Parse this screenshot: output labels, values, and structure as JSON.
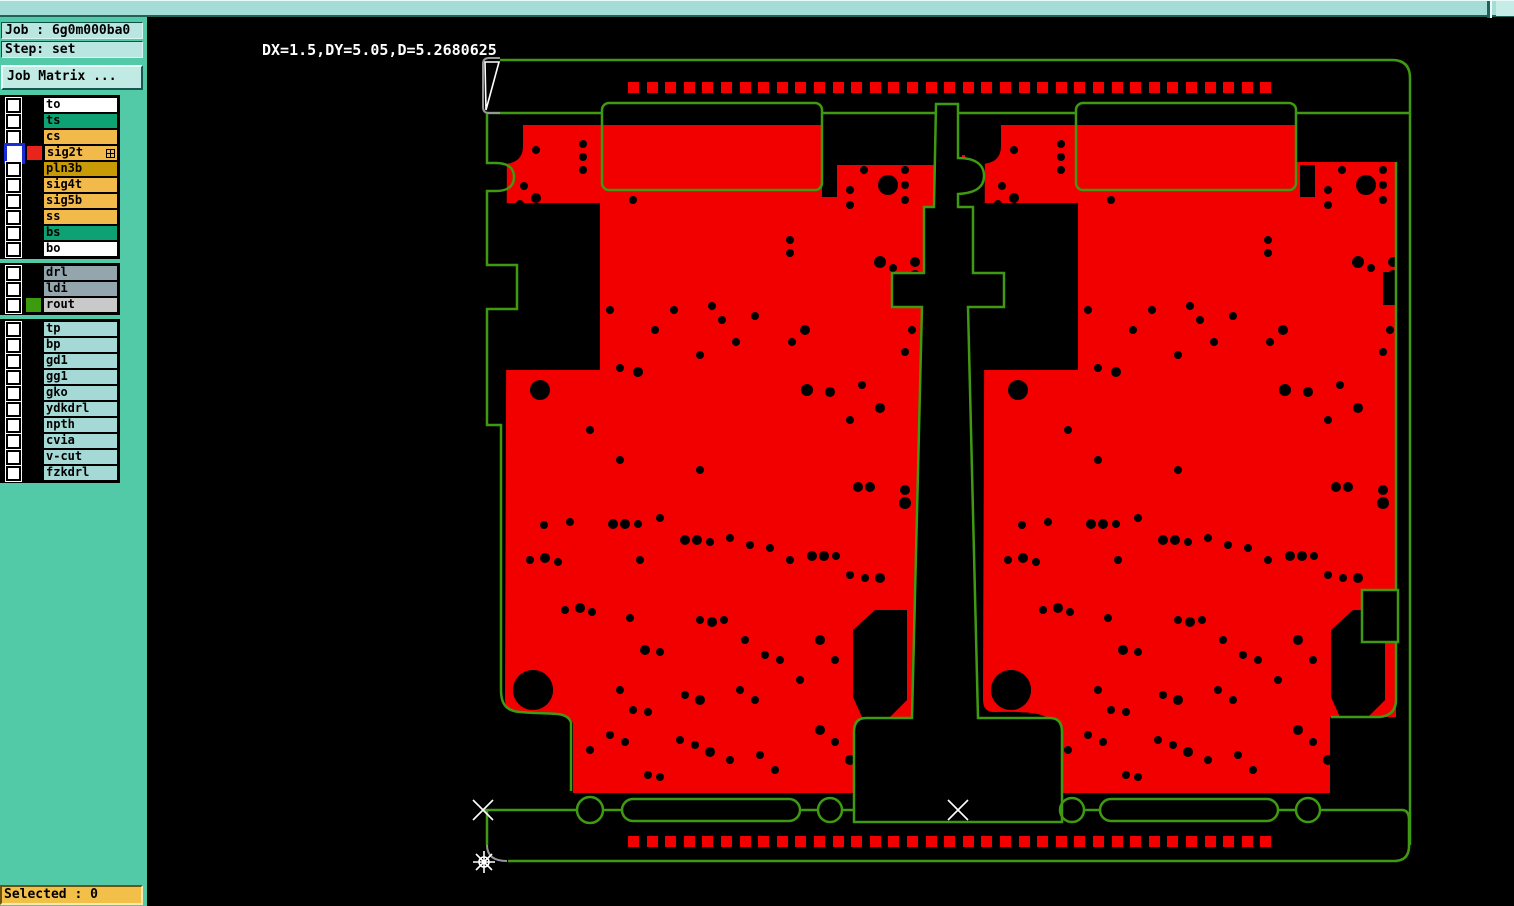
{
  "titlebar": {
    "note": ""
  },
  "sidebar": {
    "job_label": "Job : 6g0m000ba0",
    "step_label": "Step: set",
    "matrix_button": "Job Matrix ...",
    "selected_label": "Selected : 0",
    "layer_groups": [
      {
        "rows": [
          {
            "name": "to",
            "bg": "#ffffff",
            "chip": null,
            "selected": false,
            "expand": false
          },
          {
            "name": "ts",
            "bg": "#0da173",
            "chip": null,
            "selected": false,
            "expand": false
          },
          {
            "name": "cs",
            "bg": "#f2b94b",
            "chip": null,
            "selected": false,
            "expand": false
          },
          {
            "name": "sig2t",
            "bg": "#f2b94b",
            "chip": "#e8241c",
            "selected": true,
            "expand": true
          },
          {
            "name": "pln3b",
            "bg": "#c79a06",
            "chip": null,
            "selected": false,
            "expand": false
          },
          {
            "name": "sig4t",
            "bg": "#f2b94b",
            "chip": null,
            "selected": false,
            "expand": false
          },
          {
            "name": "sig5b",
            "bg": "#f2b94b",
            "chip": null,
            "selected": false,
            "expand": false
          },
          {
            "name": "ss",
            "bg": "#f2b94b",
            "chip": null,
            "selected": false,
            "expand": false
          },
          {
            "name": "bs",
            "bg": "#0da173",
            "chip": null,
            "selected": false,
            "expand": false
          },
          {
            "name": "bo",
            "bg": "#ffffff",
            "chip": null,
            "selected": false,
            "expand": false
          }
        ]
      },
      {
        "rows": [
          {
            "name": "drl",
            "bg": "#93a5ad",
            "chip": null,
            "selected": false,
            "expand": false
          },
          {
            "name": "ldi",
            "bg": "#93a5ad",
            "chip": null,
            "selected": false,
            "expand": false
          },
          {
            "name": "rout",
            "bg": "#c9c9c9",
            "chip": "#3c9b0e",
            "selected": false,
            "expand": false
          }
        ]
      },
      {
        "rows": [
          {
            "name": "tp",
            "bg": "#a5d9d5",
            "chip": null,
            "selected": false,
            "expand": false
          },
          {
            "name": "bp",
            "bg": "#a5d9d5",
            "chip": null,
            "selected": false,
            "expand": false
          },
          {
            "name": "gd1",
            "bg": "#a5d9d5",
            "chip": null,
            "selected": false,
            "expand": false
          },
          {
            "name": "gg1",
            "bg": "#a5d9d5",
            "chip": null,
            "selected": false,
            "expand": false
          },
          {
            "name": "gko",
            "bg": "#a5d9d5",
            "chip": null,
            "selected": false,
            "expand": false
          },
          {
            "name": "ydkdrl",
            "bg": "#a5d9d5",
            "chip": null,
            "selected": false,
            "expand": false
          },
          {
            "name": "npth",
            "bg": "#a5d9d5",
            "chip": null,
            "selected": false,
            "expand": false
          },
          {
            "name": "cvia",
            "bg": "#a5d9d5",
            "chip": null,
            "selected": false,
            "expand": false
          },
          {
            "name": "v-cut",
            "bg": "#a5d9d5",
            "chip": null,
            "selected": false,
            "expand": false
          },
          {
            "name": "fzkdrl",
            "bg": "#a5d9d5",
            "chip": null,
            "selected": false,
            "expand": false
          }
        ]
      }
    ]
  },
  "main": {
    "readout": "DX=1.5,DY=5.05,D=5.2680625",
    "colors": {
      "copper": "#f20000",
      "outline": "#3f9a12",
      "marker": "#ffffff",
      "corner": "#979797",
      "background": "#000000"
    },
    "fiducial_squares": {
      "count": 35,
      "x_start": 628,
      "pitch": 18.6,
      "size": 11,
      "y_top": 82,
      "y_bottom": 836
    },
    "board_offset_x": 478,
    "drills": [
      [
        583,
        144,
        4
      ],
      [
        583,
        157,
        4
      ],
      [
        583,
        170,
        4
      ],
      [
        536,
        150,
        4
      ],
      [
        524,
        186,
        4
      ],
      [
        536,
        198,
        5
      ],
      [
        520,
        204,
        4
      ],
      [
        888,
        185,
        10
      ],
      [
        905,
        170,
        4
      ],
      [
        905,
        185,
        4
      ],
      [
        905,
        200,
        4
      ],
      [
        864,
        144,
        4
      ],
      [
        864,
        157,
        4
      ],
      [
        864,
        170,
        4
      ],
      [
        633,
        200,
        4
      ],
      [
        674,
        310,
        4
      ],
      [
        712,
        306,
        4
      ],
      [
        722,
        320,
        4
      ],
      [
        755,
        316,
        4
      ],
      [
        700,
        355,
        4
      ],
      [
        736,
        342,
        4
      ],
      [
        805,
        330,
        5
      ],
      [
        792,
        342,
        4
      ],
      [
        807,
        390,
        6
      ],
      [
        830,
        392,
        5
      ],
      [
        862,
        385,
        4
      ],
      [
        880,
        408,
        5
      ],
      [
        540,
        390,
        10
      ],
      [
        620,
        368,
        4
      ],
      [
        638,
        372,
        5
      ],
      [
        655,
        330,
        4
      ],
      [
        610,
        310,
        4
      ],
      [
        590,
        308,
        4
      ],
      [
        915,
        262,
        5
      ],
      [
        915,
        275,
        5
      ],
      [
        915,
        287,
        6
      ],
      [
        880,
        262,
        6
      ],
      [
        893,
        268,
        4
      ],
      [
        912,
        330,
        4
      ],
      [
        925,
        345,
        4
      ],
      [
        905,
        352,
        4
      ],
      [
        544,
        525,
        4
      ],
      [
        570,
        522,
        4
      ],
      [
        613,
        524,
        5
      ],
      [
        625,
        524,
        5
      ],
      [
        638,
        524,
        4
      ],
      [
        660,
        518,
        4
      ],
      [
        685,
        540,
        5
      ],
      [
        697,
        540,
        5
      ],
      [
        710,
        542,
        4
      ],
      [
        730,
        538,
        4
      ],
      [
        750,
        545,
        4
      ],
      [
        770,
        548,
        4
      ],
      [
        530,
        560,
        4
      ],
      [
        545,
        558,
        5
      ],
      [
        558,
        562,
        4
      ],
      [
        790,
        560,
        4
      ],
      [
        812,
        556,
        5
      ],
      [
        824,
        556,
        5
      ],
      [
        836,
        556,
        4
      ],
      [
        850,
        575,
        4
      ],
      [
        865,
        578,
        4
      ],
      [
        880,
        578,
        5
      ],
      [
        565,
        610,
        4
      ],
      [
        580,
        608,
        5
      ],
      [
        592,
        612,
        4
      ],
      [
        630,
        618,
        4
      ],
      [
        645,
        650,
        5
      ],
      [
        660,
        652,
        4
      ],
      [
        700,
        620,
        4
      ],
      [
        712,
        622,
        5
      ],
      [
        724,
        620,
        4
      ],
      [
        745,
        640,
        4
      ],
      [
        765,
        655,
        4
      ],
      [
        780,
        660,
        4
      ],
      [
        820,
        640,
        5
      ],
      [
        835,
        660,
        4
      ],
      [
        800,
        680,
        4
      ],
      [
        740,
        690,
        4
      ],
      [
        755,
        700,
        4
      ],
      [
        700,
        700,
        5
      ],
      [
        685,
        695,
        4
      ],
      [
        620,
        690,
        4
      ],
      [
        633,
        710,
        4
      ],
      [
        648,
        712,
        4
      ],
      [
        610,
        735,
        4
      ],
      [
        625,
        742,
        4
      ],
      [
        590,
        750,
        4
      ],
      [
        680,
        740,
        4
      ],
      [
        695,
        745,
        4
      ],
      [
        710,
        752,
        5
      ],
      [
        730,
        760,
        4
      ],
      [
        760,
        755,
        4
      ],
      [
        775,
        770,
        4
      ],
      [
        820,
        730,
        5
      ],
      [
        835,
        742,
        4
      ],
      [
        850,
        760,
        5
      ],
      [
        865,
        770,
        4
      ],
      [
        880,
        740,
        4
      ],
      [
        533,
        690,
        20
      ],
      [
        648,
        775,
        4
      ],
      [
        660,
        777,
        4
      ],
      [
        850,
        190,
        4
      ],
      [
        850,
        205,
        4
      ],
      [
        790,
        240,
        4
      ],
      [
        790,
        253,
        4
      ],
      [
        905,
        490,
        5
      ],
      [
        905,
        503,
        6
      ],
      [
        870,
        487,
        5
      ],
      [
        858,
        487,
        5
      ],
      [
        620,
        460,
        4
      ],
      [
        700,
        470,
        4
      ],
      [
        590,
        430,
        4
      ],
      [
        850,
        420,
        4
      ],
      [
        640,
        560,
        4
      ]
    ]
  }
}
